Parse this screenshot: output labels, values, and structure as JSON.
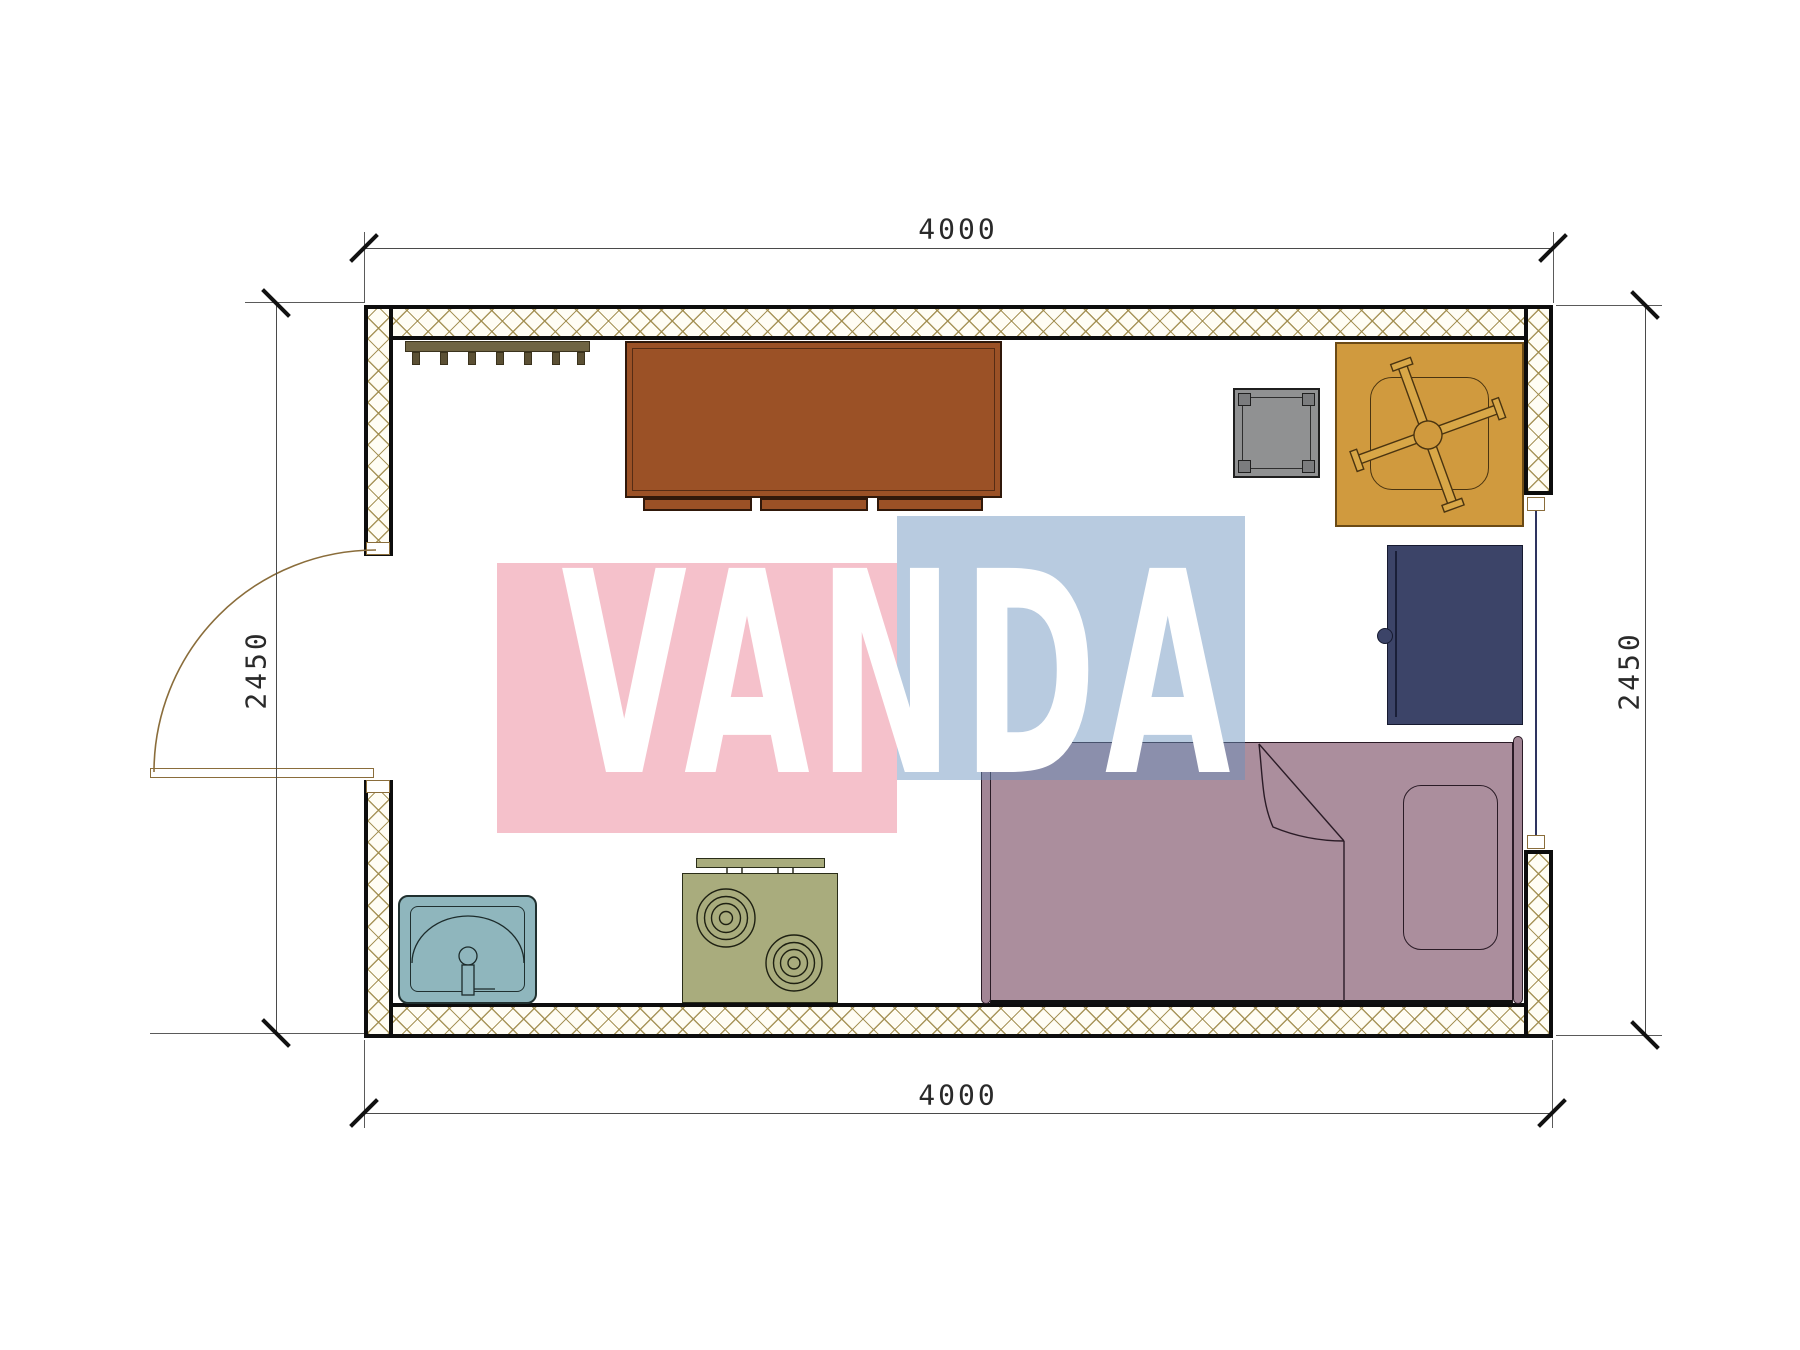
{
  "drawing": {
    "type": "floor-plan",
    "room_width_mm": "4000",
    "room_depth_mm": "2450"
  },
  "dimensions": {
    "top": {
      "label": "4000"
    },
    "bottom": {
      "label": "4000"
    },
    "left": {
      "label": "2450"
    },
    "right": {
      "label": "2450"
    }
  },
  "watermark": {
    "text": "VANDA",
    "pink_color": "#f5c0cb",
    "blue_color": "#bccde0",
    "text_color": "#ffffff"
  },
  "furniture": [
    {
      "name": "coat-rack",
      "color": "#6f6443"
    },
    {
      "name": "desk",
      "color": "#9b5126"
    },
    {
      "name": "stool",
      "color": "#909192"
    },
    {
      "name": "office-chair",
      "color": "#d09a3e"
    },
    {
      "name": "wardrobe",
      "color": "#3c4468"
    },
    {
      "name": "bed",
      "color": "#ab8e9d"
    },
    {
      "name": "sink",
      "color": "#8fb6bd"
    },
    {
      "name": "stove",
      "color": "#a9ac7d"
    }
  ],
  "openings": [
    {
      "name": "door",
      "wall": "left",
      "swing": "outward"
    },
    {
      "name": "window",
      "wall": "right"
    }
  ],
  "wall_hatch_color": "#9e8a4a"
}
